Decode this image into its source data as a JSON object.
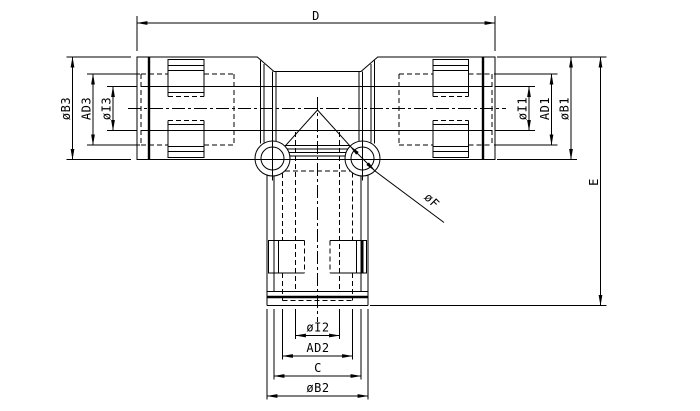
{
  "drawing": {
    "type": "engineering-dimension-drawing",
    "subject": "union-tee-pneumatic-fitting",
    "colors": {
      "line": "#000000",
      "background": "#ffffff"
    },
    "labels": {
      "d": "D",
      "e": "E",
      "c": "C",
      "b1": "øB1",
      "b2": "øB2",
      "b3": "øB3",
      "i1": "øI1",
      "i2": "øI2",
      "i3": "øI3",
      "ad1": "AD1",
      "ad2": "AD2",
      "ad3": "AD3",
      "f": "øF"
    }
  }
}
